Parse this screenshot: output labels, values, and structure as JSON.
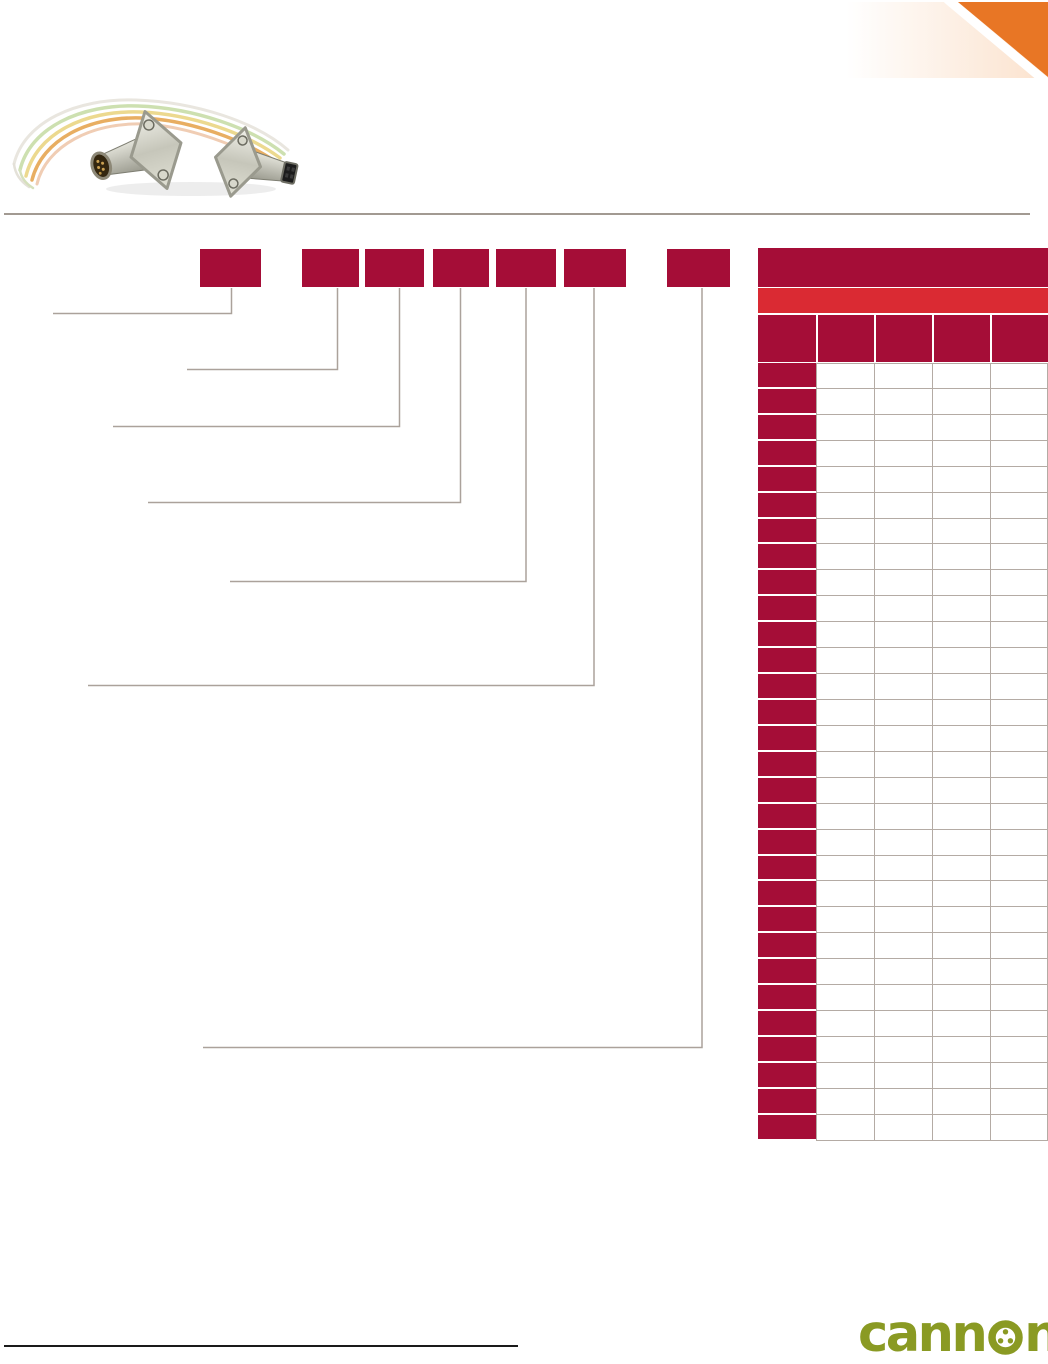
{
  "page": {
    "width": 1048,
    "height": 1350,
    "background": "#ffffff"
  },
  "colors": {
    "maroon": "#a50d37",
    "red_band": "#da2a33",
    "orange_corner": "#e87625",
    "peach_gradient": "#fbe2cd",
    "table_grid_line": "#b4aba4",
    "callout_line": "#aba29b",
    "divider_rule": "#a29a92",
    "bottom_rule": "#1a1a1a",
    "logo_green": "#8a9a23"
  },
  "banner": {
    "icon": "orange-corner-ribbon"
  },
  "product_photo": {
    "icon": "micro-connector-cable-photo"
  },
  "part_code": {
    "box_count": 7,
    "box_labels": [
      "",
      "",
      "",
      "",
      "",
      "",
      ""
    ]
  },
  "ordering_table": {
    "column_count": 5,
    "data_row_count": 30,
    "title_band_label": "",
    "subtitle_band_label": "",
    "header_labels": [
      "",
      "",
      "",
      "",
      ""
    ]
  },
  "footer": {
    "logo_prefix": "cann",
    "logo_suffix": "n",
    "logo_full_text": "cannon",
    "logo_o_icon": "connector-face-icon"
  }
}
